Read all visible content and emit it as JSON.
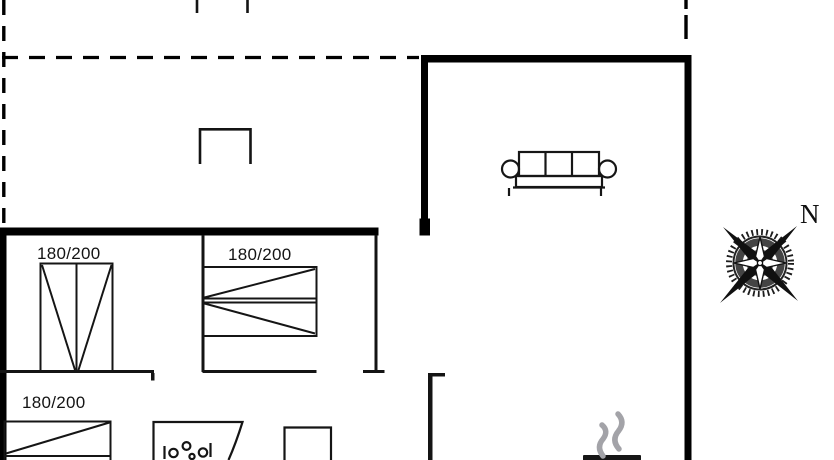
{
  "plan": {
    "kind": "holiday-home floor plan",
    "compass": {
      "north_label": "N"
    },
    "beds": [
      {
        "room": "bedroom-1",
        "label": "180/200"
      },
      {
        "room": "bedroom-2",
        "label": "180/200"
      },
      {
        "room": "bedroom-3",
        "label": "180/200"
      }
    ],
    "icons": [
      "double-bed-icon",
      "double-bed-icon",
      "double-bed-icon",
      "sofa-icon",
      "washbasin-icon",
      "cabinet-icon",
      "wood-stove-icon",
      "smoke-icon",
      "compass-rose-icon"
    ],
    "colors": {
      "wall": "#000000",
      "furniture_line": "#151515",
      "smoke": "#a3a3a8",
      "label": "#141414",
      "background": "#ffffff"
    }
  }
}
